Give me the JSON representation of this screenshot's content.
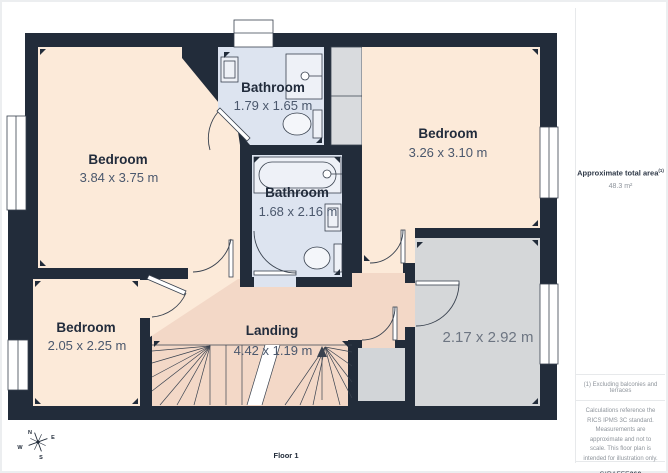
{
  "colors": {
    "wall": "#222c3a",
    "bedroom_floor": "#fcead9",
    "landing_floor": "#f3d8c7",
    "bathroom_floor": "#dde4f0",
    "store_floor": "#d5d7d9",
    "line": "#39424f"
  },
  "plan": {
    "rooms": [
      {
        "id": "bedroom-1",
        "name": "Bedroom",
        "dims": "3.84 x 3.75 m"
      },
      {
        "id": "bathroom-1",
        "name": "Bathroom",
        "dims": "1.79 x 1.65 m"
      },
      {
        "id": "bedroom-2",
        "name": "Bedroom",
        "dims": "3.26 x 3.10 m"
      },
      {
        "id": "bathroom-2",
        "name": "Bathroom",
        "dims": "1.68 x 2.16 m"
      },
      {
        "id": "bedroom-3",
        "name": "Bedroom",
        "dims": "2.05 x 2.25 m"
      },
      {
        "id": "landing",
        "name": "Landing",
        "dims": "4.42 x 1.19 m"
      },
      {
        "id": "store-room",
        "name": "",
        "dims": "2.17 x 2.92 m"
      }
    ],
    "floor_label": "Floor 1",
    "compass": {
      "n": "N",
      "e": "E",
      "s": "S",
      "w": "W"
    }
  },
  "sidebar": {
    "area_label": "Approximate total area",
    "area_footnote_marker": "(1)",
    "area_value": "48.3 m²",
    "footnote": "(1) Excluding balconies and terraces",
    "disclaimer": "Calculations reference the RICS IPMS 3C standard. Measurements are approximate and not to scale. This floor plan is intended for illustration only.",
    "brand_name": "GIRAFFE",
    "brand_suffix": "360"
  }
}
